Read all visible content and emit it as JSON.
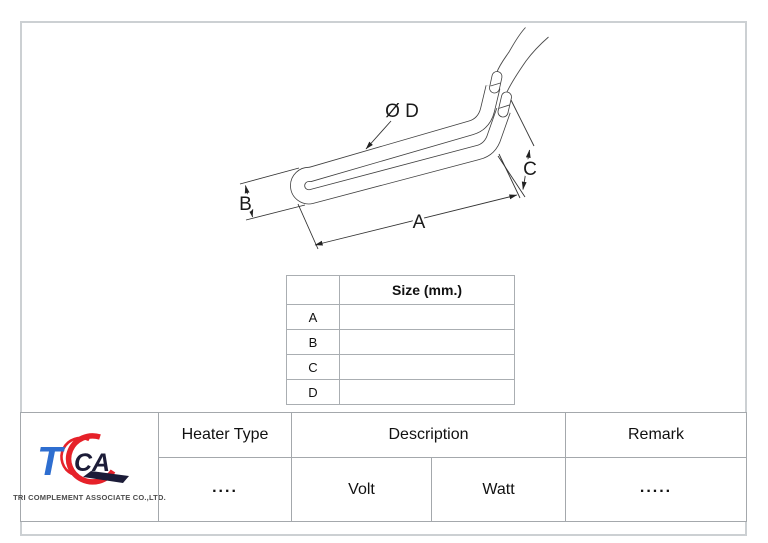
{
  "drawing": {
    "dim_diameter": "Ø D",
    "dim_length": "A",
    "dim_width": "B",
    "dim_height": "C"
  },
  "size_table": {
    "header": "Size (mm.)",
    "rows": [
      {
        "label": "A",
        "value": ""
      },
      {
        "label": "B",
        "value": ""
      },
      {
        "label": "C",
        "value": ""
      },
      {
        "label": "D",
        "value": ""
      }
    ]
  },
  "title_block": {
    "heater_type_label": "Heater Type",
    "heater_type_value": "....",
    "description_label": "Description",
    "volt_label": "Volt",
    "watt_label": "Watt",
    "remark_label": "Remark",
    "remark_value": "....."
  },
  "logo": {
    "monogram_t": "T",
    "monogram_ca": "CA",
    "company_name": "TRI COMPLEMENT ASSOCIATE CO.,LTD.",
    "colors": {
      "blue": "#2e6ed0",
      "red": "#e62129",
      "dark": "#1c1c38"
    }
  }
}
